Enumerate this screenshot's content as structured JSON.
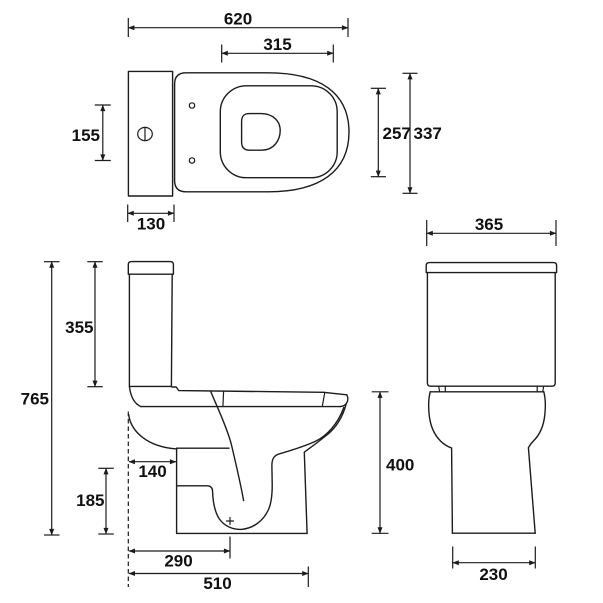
{
  "drawing": {
    "background": "#ffffff",
    "ink": "#1c1c1c",
    "plan_view": {
      "dim_overall_length": "620",
      "dim_seat_opening_length": "315",
      "dim_flush_button_zone": "155",
      "dim_bowl_opening_width": "257",
      "dim_seat_width": "337",
      "dim_cistern_depth": "130"
    },
    "side_view": {
      "dim_overall_height": "765",
      "dim_cistern_height": "355",
      "dim_outlet_setback": "140",
      "dim_outlet_height": "185",
      "dim_outlet_center_from_wall": "290",
      "dim_overall_depth": "510",
      "dim_pan_height": "400"
    },
    "front_view": {
      "dim_cistern_width": "365",
      "dim_base_width": "230"
    }
  }
}
